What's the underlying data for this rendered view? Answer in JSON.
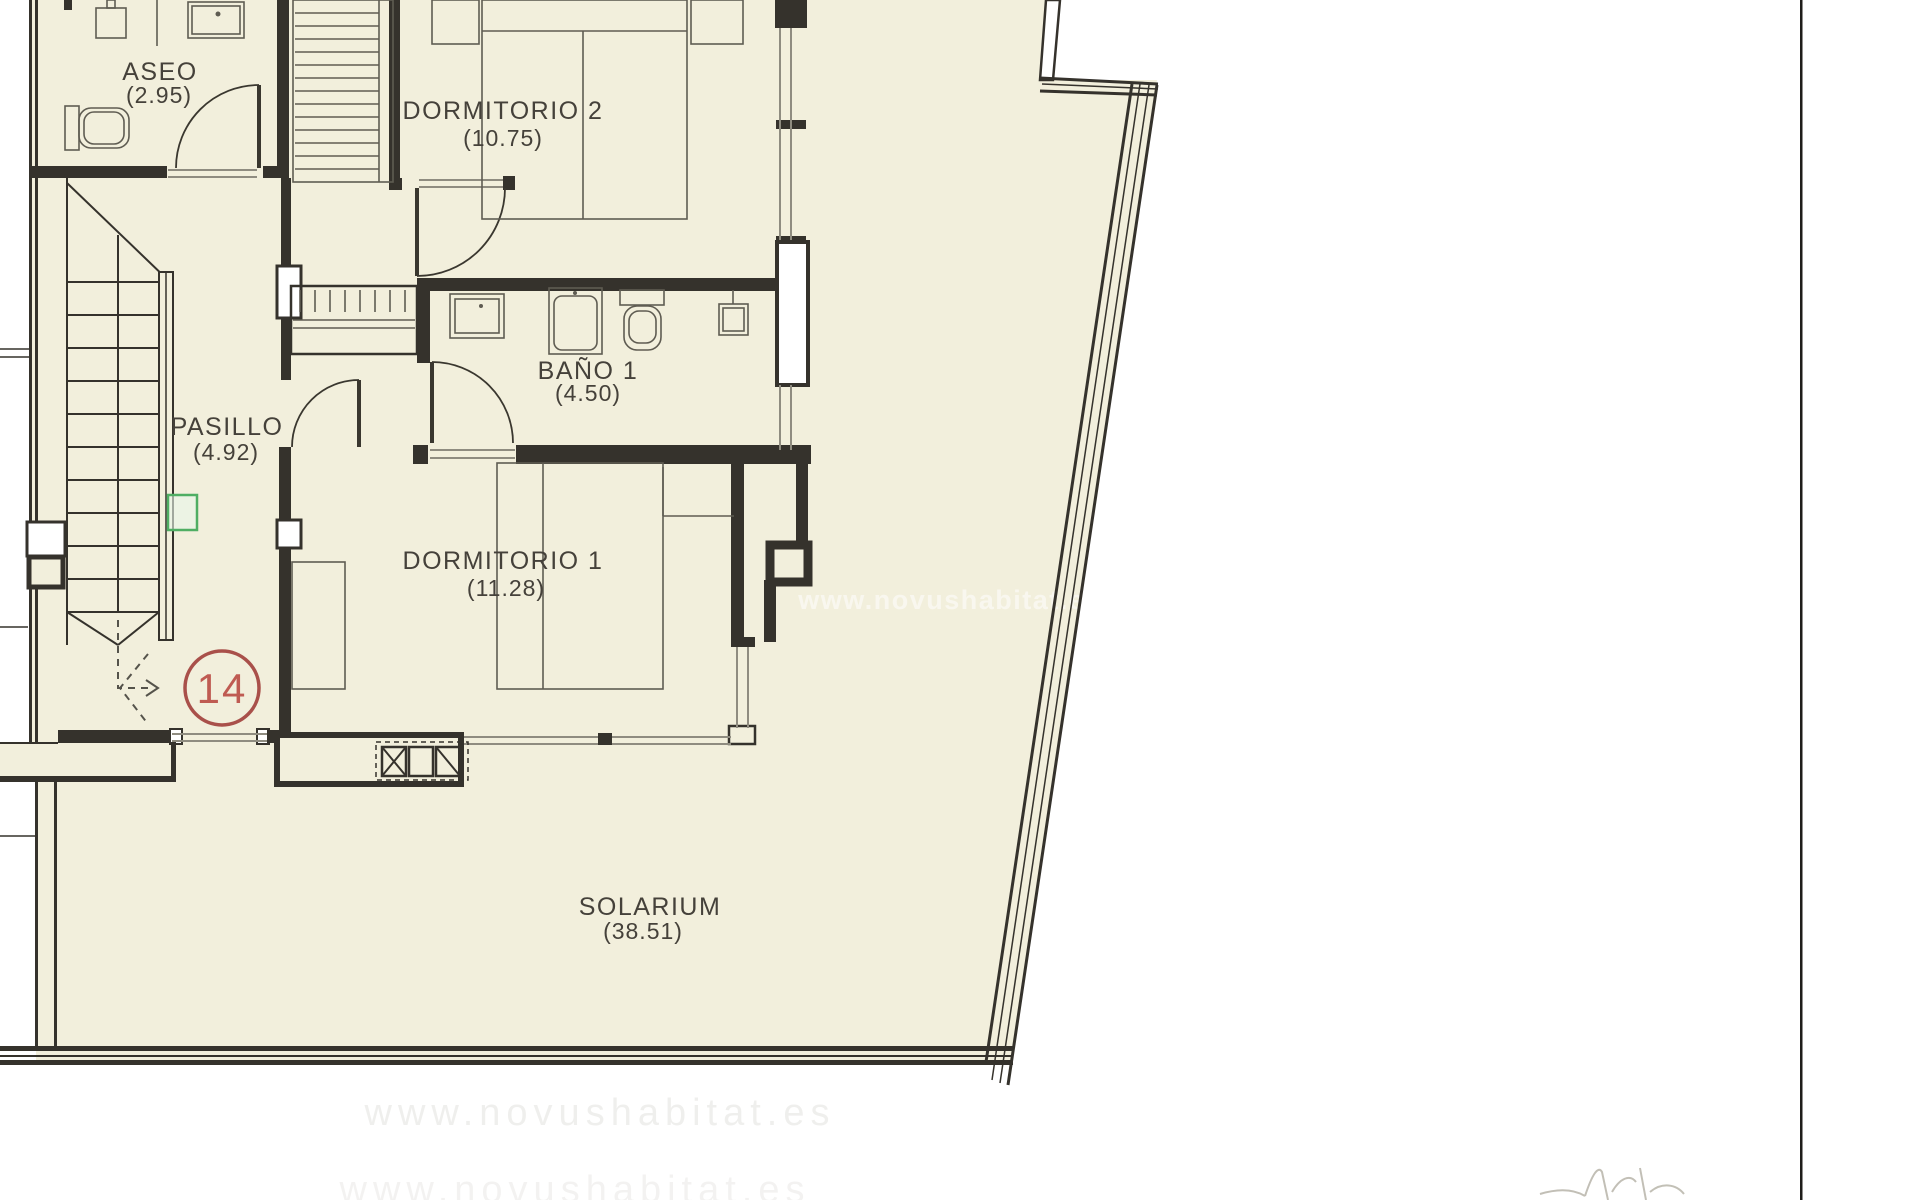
{
  "plan": {
    "unit_number": "14",
    "watermark": "www.novushabitat.es",
    "rooms": [
      {
        "id": "aseo",
        "name": "ASEO",
        "area": "(2.95)"
      },
      {
        "id": "dormitorio-2",
        "name": "DORMITORIO 2",
        "area": "(10.75)"
      },
      {
        "id": "bano-1",
        "name": "BAÑO 1",
        "area": "(4.50)"
      },
      {
        "id": "pasillo",
        "name": "PASILLO",
        "area": "(4.92)"
      },
      {
        "id": "dormitorio-1",
        "name": "DORMITORIO 1",
        "area": "(11.28)"
      },
      {
        "id": "solarium",
        "name": "SOLARIUM",
        "area": "(38.51)"
      }
    ],
    "colors": {
      "floor": "#f2efdc",
      "wall": "#35322c",
      "furniture": "#5f5c52",
      "window": "#8f8c80",
      "unit_badge": "#a9504a",
      "unit_text": "#bf5b52",
      "panel_green": "#4fae63",
      "watermark": "#ffffff"
    }
  }
}
